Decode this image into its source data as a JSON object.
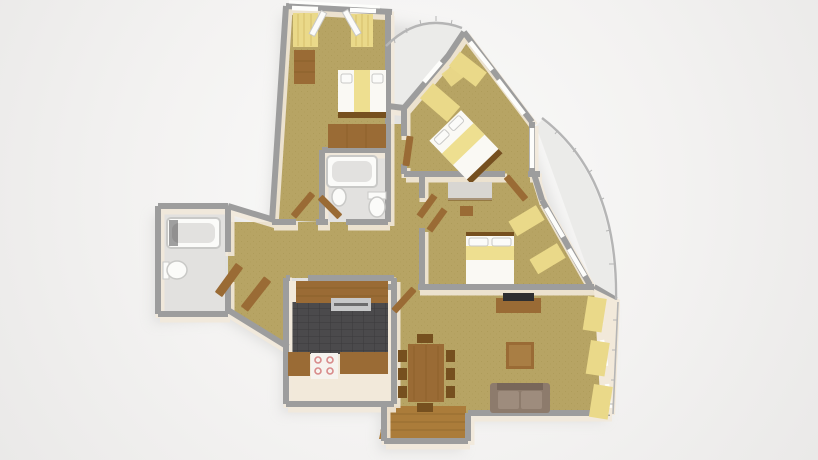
{
  "scene": {
    "title": "3D apartment floor plan render",
    "description": "Overhead 3D dollhouse-style architectural render of a three-bedroom apartment on a plain light studio backdrop. Gray wall tops, cream wall faces, tan carpet, wooden furniture and pale yellow curtains.",
    "view": "top-down 3D cutaway",
    "visible_text": "none"
  },
  "palette": {
    "wall": "#9d9d9d",
    "wall_face": "#f2e9da",
    "wall_white": "#fdfdfb",
    "carpet": "#b7a464",
    "carpet_dark": "#96823f",
    "wood": "#9a6b35",
    "wood_dark": "#76501f",
    "wood_light": "#b48a4e",
    "floor_wood": "#ab7c3a",
    "bath_floor": "#e2e1df",
    "balcony_floor": "#ebebe9",
    "fixture": "#fbfbf9",
    "fixture_shadow": "#c9c9c7",
    "kitchen_floor": "#4b4a4c",
    "kitchen_grout": "#3b3a3c",
    "curtain": "#ead989",
    "curtain_dark": "#cdb45c",
    "bed_white": "#faf9f4",
    "bed_yellow": "#eedf90",
    "sofa": "#8d7b6c",
    "sofa_dark": "#78675a",
    "sofa_light": "#9e8c7d",
    "desk_top": "#d8d6d2",
    "tv": "#2e2e30",
    "metal": "#c7c8c9",
    "stove": "#f6f3ef",
    "burner": "#d88a8a",
    "railing": "#b5b5b5",
    "shadow": "#cccccb"
  },
  "rooms": [
    {
      "id": "bedroom-1",
      "label": "Bedroom 1 (top left)",
      "floor": "tan carpet",
      "furniture": [
        "double bed with pale yellow runner",
        "wooden dresser",
        "built-in wardrobe",
        "two windows with yellow curtains",
        "open french balcony door"
      ]
    },
    {
      "id": "balcony-top",
      "label": "Top balcony",
      "floor": "pale concrete",
      "furniture": [
        "curved metal railing"
      ]
    },
    {
      "id": "bedroom-2",
      "label": "Bedroom 2 (top right)",
      "floor": "tan carpet",
      "furniture": [
        "double bed placed diagonally",
        "yellow curtains",
        "diagonal window wall",
        "open door"
      ]
    },
    {
      "id": "bedroom-3",
      "label": "Bedroom 3 (middle right)",
      "floor": "tan carpet",
      "furniture": [
        "double bed with yellow band",
        "desk",
        "stool",
        "open wardrobe doors",
        "windows with yellow curtains"
      ]
    },
    {
      "id": "living-room",
      "label": "Living room (bottom right)",
      "floor": "tan carpet with wooden entry area",
      "furniture": [
        "dining table with eight chairs",
        "square coffee table",
        "two-seat sofa",
        "tv cabinet with tv",
        "three windows with yellow curtains"
      ]
    },
    {
      "id": "kitchen",
      "label": "Kitchen",
      "floor": "dark gray tile",
      "furniture": [
        "counter with sink and hood",
        "cooktop with four burners",
        "two lower counters"
      ]
    },
    {
      "id": "bathroom-main",
      "label": "Main bathroom (center)",
      "floor": "light gray",
      "furniture": [
        "bathtub",
        "wash basin",
        "toilet"
      ]
    },
    {
      "id": "bathroom-second",
      "label": "Second bathroom (left)",
      "floor": "light gray",
      "furniture": [
        "bathtub",
        "toilet"
      ]
    },
    {
      "id": "hallway",
      "label": "Hallway",
      "floor": "tan carpet",
      "furniture": [
        "several open wooden doors"
      ]
    },
    {
      "id": "balcony-right",
      "label": "Right balcony",
      "floor": "pale concrete",
      "furniture": [
        "curved metal railing"
      ]
    }
  ]
}
